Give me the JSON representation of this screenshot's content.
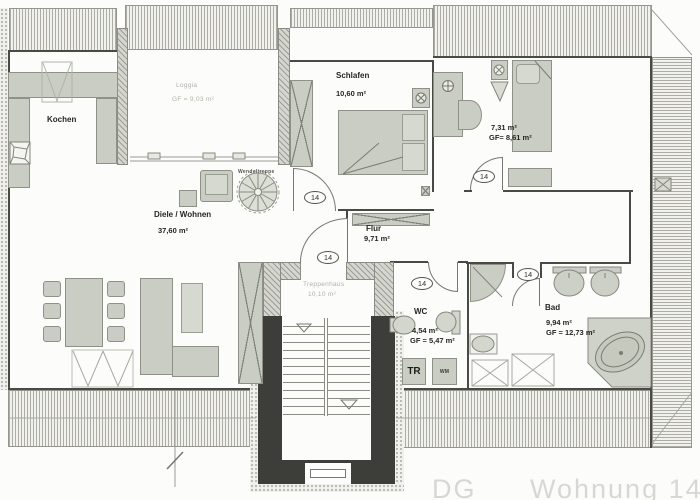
{
  "plan": {
    "type": "apartment-floor-plan",
    "watermark": {
      "dg": "DG",
      "wohnung": "Wohnung 14"
    },
    "rooms": {
      "kochen": {
        "name": "Kochen"
      },
      "loggia": {
        "name": "Loggia",
        "gf": "GF = 9,03 m²"
      },
      "diele": {
        "name": "Diele / Wohnen",
        "area": "37,60 m²"
      },
      "schlafen": {
        "name": "Schlafen",
        "area": "10,60 m²"
      },
      "zimmer": {
        "area": "7,31 m²",
        "gf": "GF= 8,61 m²"
      },
      "flur": {
        "name": "Flur",
        "area": "9,71 m²"
      },
      "treppenhaus": {
        "name": "Treppenhaus",
        "area": "10,10 m²"
      },
      "wc": {
        "name": "WC",
        "area": "4,54 m²",
        "gf": "GF = 5,47 m²"
      },
      "bad": {
        "name": "Bad",
        "area": "9,94 m²",
        "gf": "GF = 12,73 m²"
      }
    },
    "labels": {
      "wendeltreppe": "Wendeltreppe",
      "door_tag": "14",
      "tr": "TR",
      "wm": "WM"
    },
    "colors": {
      "furniture": "#c9cdc3",
      "stairwell_wall": "#3d3d3a",
      "wall_line": "#4a4a45",
      "hatch": "#adada6",
      "faint_text": "#b2b2aa",
      "label_text": "#262622",
      "watermark": "#d8d8d2"
    }
  }
}
